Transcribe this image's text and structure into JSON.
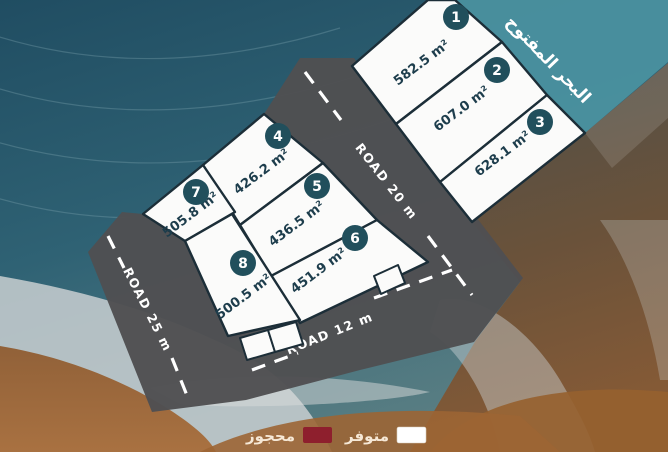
{
  "sea_banner": {
    "label": "البحر المفتوح"
  },
  "plots": [
    {
      "number": "1",
      "area": "582.5 m²",
      "status": "available"
    },
    {
      "number": "2",
      "area": "607.0 m²",
      "status": "available"
    },
    {
      "number": "3",
      "area": "628.1 m²",
      "status": "available"
    },
    {
      "number": "4",
      "area": "426.2 m²",
      "status": "available"
    },
    {
      "number": "5",
      "area": "436.5 m²",
      "status": "available"
    },
    {
      "number": "6",
      "area": "451.9 m²",
      "status": "available"
    },
    {
      "number": "7",
      "area": "505.8 m²",
      "status": "available"
    },
    {
      "number": "8",
      "area": "500.5 m²",
      "status": "available"
    }
  ],
  "roads": [
    {
      "label": "ROAD 20 m"
    },
    {
      "label": "ROAD 12 m"
    },
    {
      "label": "ROAD 25 m"
    }
  ],
  "legend": {
    "available": {
      "label": "متوفر",
      "color": "#ffffff"
    },
    "reserved": {
      "label": "محجوز",
      "color": "#8e1f2d"
    }
  },
  "colors": {
    "banner_teal": "#4b93a1",
    "road_gray": "#505052",
    "badge_navy": "#214f5c"
  }
}
